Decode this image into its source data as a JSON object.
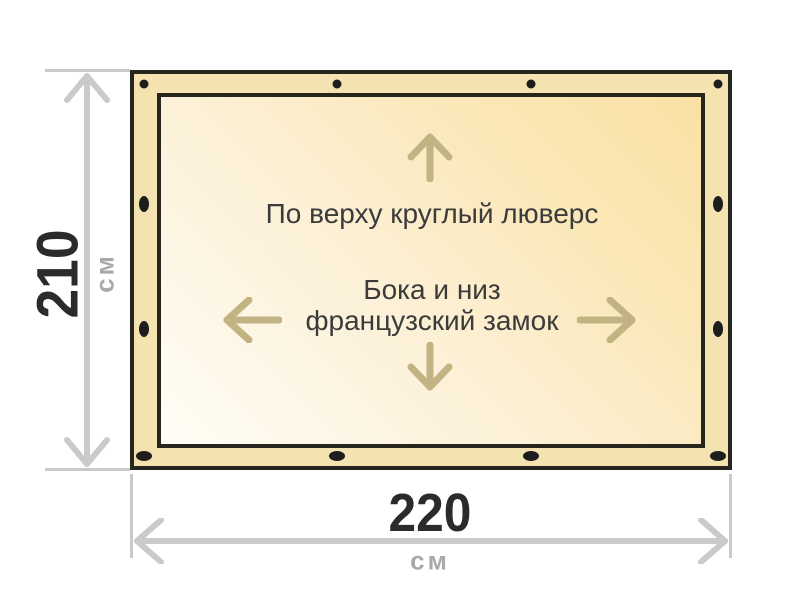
{
  "diagram": {
    "type": "product-dimension-diagram",
    "annotations": {
      "top": "По верху круглый люверс",
      "center_line1": "Бока и низ",
      "center_line2": "французский замок"
    },
    "dimensions": {
      "height": {
        "value": "210",
        "unit": "см"
      },
      "width": {
        "value": "220",
        "unit": "см"
      }
    },
    "grommets": {
      "count": 12,
      "top_edge_shape": "round",
      "side_edges_shape": "oval-vertical",
      "bottom_edge_shape": "oval-horizontal"
    },
    "colors": {
      "background": "#ffffff",
      "outline": "#26261e",
      "band_fill": "#f5e2b1",
      "panel_fill_light": "#fffdf6",
      "panel_fill_dark": "#fae0a4",
      "grommet": "#1d1d1b",
      "direction_arrow": "#c2b383",
      "dimension_line": "#cacaca",
      "dimension_number": "#2b2b2b",
      "dimension_unit": "#a9a9a9",
      "annotation_text": "#3b3b3b"
    }
  }
}
